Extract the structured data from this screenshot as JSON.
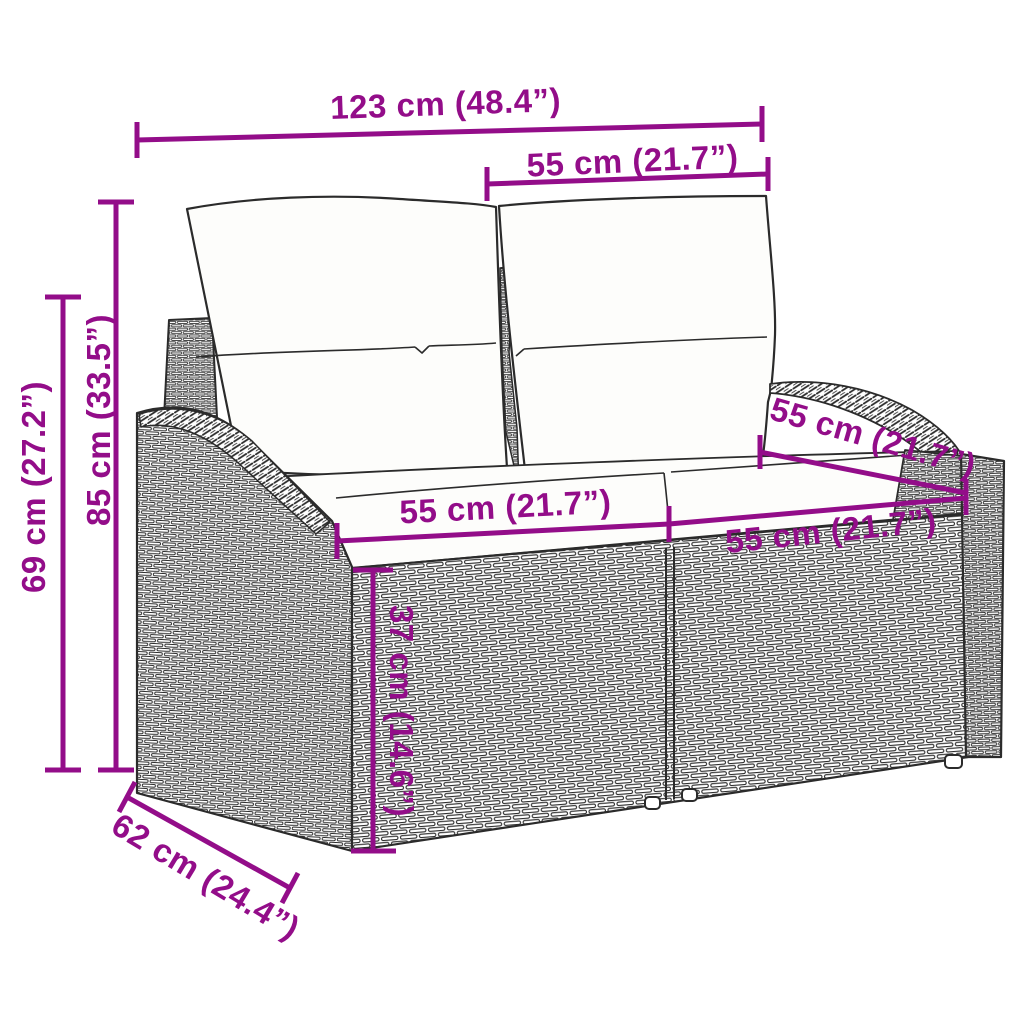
{
  "diagram": {
    "type": "product-dimension-diagram",
    "subject": "poly-rattan garden loveseat sofa with back pillows and seat cushions",
    "background_color": "#FFFFFF",
    "accent_color": "#930D89",
    "line_art_color": "#2B2B2B",
    "cushion_color": "#FDFDFB",
    "dimensions": [
      {
        "id": "overall-width",
        "label": "123 cm (48.4”)"
      },
      {
        "id": "back-cushion-width",
        "label": "55 cm (21.7”)"
      },
      {
        "id": "total-height",
        "label": "85 cm (33.5”)"
      },
      {
        "id": "armrest-height",
        "label": "69 cm (27.2”)"
      },
      {
        "id": "seat-width-left",
        "label": "55 cm (21.7”)"
      },
      {
        "id": "seat-width-right",
        "label": "55 cm (21.7”)"
      },
      {
        "id": "seat-depth",
        "label": "55 cm (21.7”)"
      },
      {
        "id": "seat-height",
        "label": "37 cm (14.6”)"
      },
      {
        "id": "overall-depth",
        "label": "62 cm (24.4”)"
      }
    ]
  }
}
